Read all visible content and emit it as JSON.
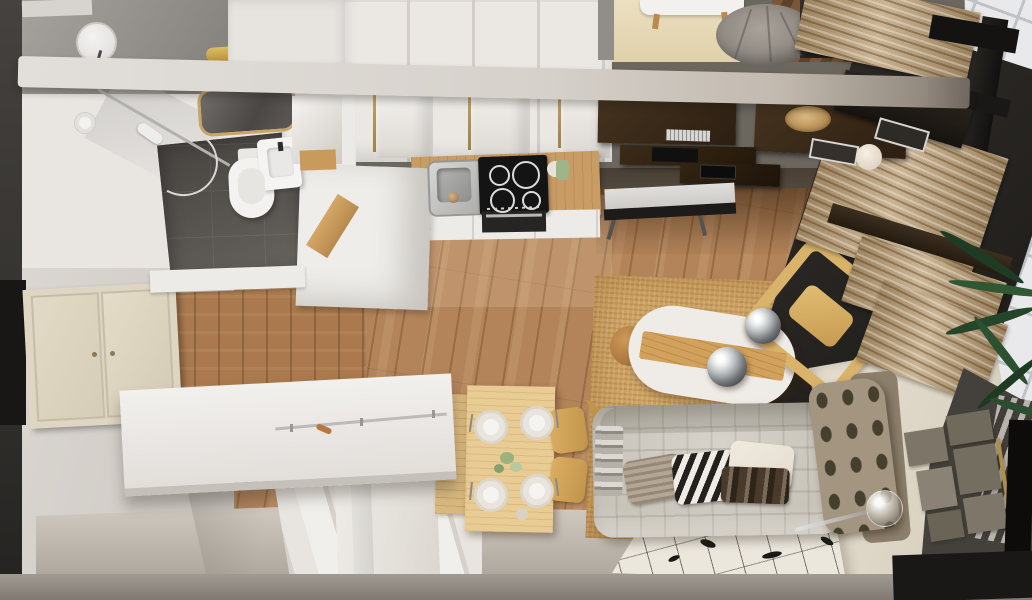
{
  "scene": {
    "type": "3d-floorplan-render",
    "label": "Top-down 3D render of a small studio apartment with bathroom, kitchen, dining and living areas",
    "palette": {
      "wood_floor": "#b3845a",
      "dark_desk_wood": "#3a2a1c",
      "white_furniture": "#edebe7",
      "jute_rug": "#cfa463",
      "sofa_fabric": "#c9c4ba",
      "curtain": "#bfa47c",
      "balcony_tile": "#e9e9eb",
      "window_frame": "#161412",
      "cream_wall": "#ded6c7",
      "bathroom_tile": "#5e5a55",
      "dining_wood": "#e9cb94",
      "brass_gold": "#c9a569",
      "plant_green": "#2a4e2f"
    },
    "areas": {
      "bathroom": {
        "label": "Bathroom with shower, toilet, vanity and gold-framed mirror"
      },
      "kitchen": {
        "label": "Kitchen with stainless sink, induction cooktop, oven and white cabinets"
      },
      "desk": {
        "label": "Dark wood desk wall with keyboard, laptop, wicker bowl and bench"
      },
      "dining": {
        "label": "Light wood dining table set for four with two curved chairs"
      },
      "living": {
        "label": "Living area with tufted sofa, zebra pillow, rugs, wine rack and stone wall art"
      },
      "stairs": {
        "label": "White staircase with landing platform and glass rail"
      },
      "balcony": {
        "label": "Tiled balcony with palm plant behind dark window frames and linen curtains"
      },
      "loft": {
        "label": "Upper level strip with round gray pouf and small white table"
      },
      "oval_table": {
        "label": "White oval table with wood plank inlay and two chrome pendant globes"
      }
    }
  }
}
